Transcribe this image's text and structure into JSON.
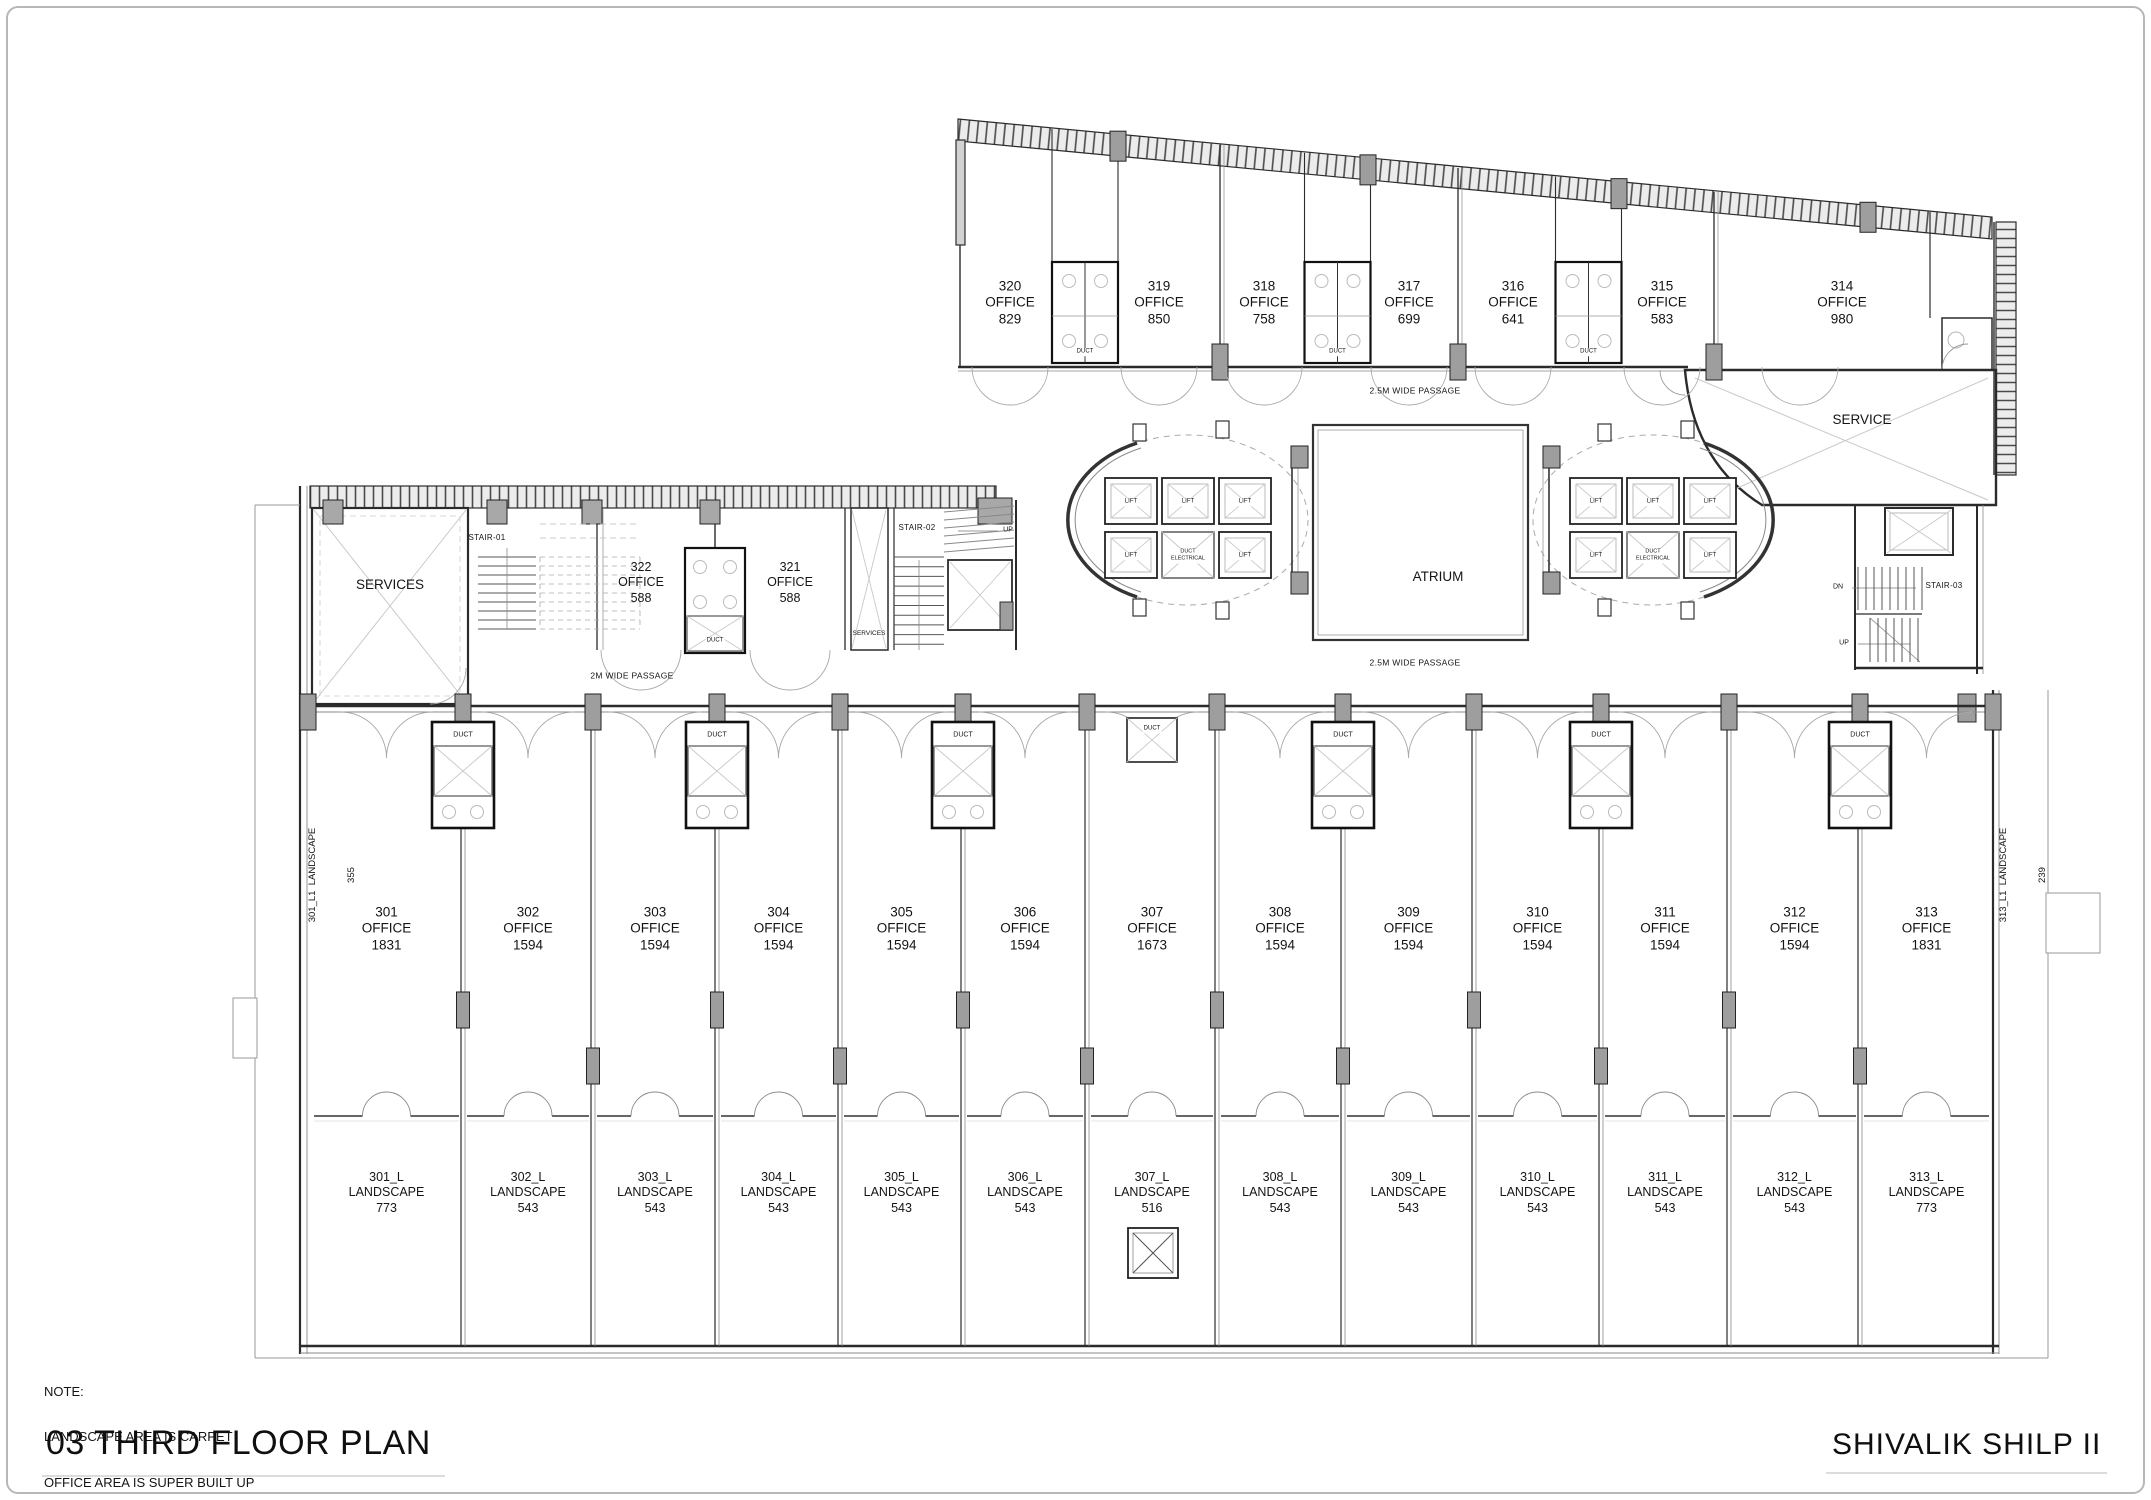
{
  "meta": {
    "plan_title": "03 THIRD FLOOR PLAN",
    "project_title": "SHIVALIK SHILP  II"
  },
  "note": {
    "heading": "NOTE:",
    "line1": "LANDSCAPE AREA IS CARPET",
    "line2": "OFFICE AREA IS SUPER BUILT UP"
  },
  "passages": {
    "top": "2.5M WIDE PASSAGE",
    "middle": "2.5M WIDE PASSAGE",
    "bottom": "2M WIDE PASSAGE"
  },
  "labels": {
    "office": "OFFICE",
    "landscape": "LANDSCAPE",
    "lift": "LIFT",
    "duct": "DUCT",
    "duct_electrical_line1": "DUCT",
    "duct_electrical_line2": "ELECTRICAL",
    "services": "SERVICES",
    "services_small": "SERVICES",
    "service": "SERVICE",
    "atrium": "ATRIUM",
    "stair_01": "STAIR-01",
    "stair_02": "STAIR-02",
    "stair_03": "STAIR-03",
    "up": "UP",
    "dn": "DN"
  },
  "top_offices": [
    {
      "number": "320",
      "area": "829"
    },
    {
      "number": "319",
      "area": "850"
    },
    {
      "number": "318",
      "area": "758"
    },
    {
      "number": "317",
      "area": "699"
    },
    {
      "number": "316",
      "area": "641"
    },
    {
      "number": "315",
      "area": "583"
    },
    {
      "number": "314",
      "area": "980"
    }
  ],
  "mid_offices": [
    {
      "number": "322",
      "area": "588"
    },
    {
      "number": "321",
      "area": "588"
    }
  ],
  "bottom_offices": [
    {
      "number": "301",
      "area": "1831"
    },
    {
      "number": "302",
      "area": "1594"
    },
    {
      "number": "303",
      "area": "1594"
    },
    {
      "number": "304",
      "area": "1594"
    },
    {
      "number": "305",
      "area": "1594"
    },
    {
      "number": "306",
      "area": "1594"
    },
    {
      "number": "307",
      "area": "1673"
    },
    {
      "number": "308",
      "area": "1594"
    },
    {
      "number": "309",
      "area": "1594"
    },
    {
      "number": "310",
      "area": "1594"
    },
    {
      "number": "311",
      "area": "1594"
    },
    {
      "number": "312",
      "area": "1594"
    },
    {
      "number": "313",
      "area": "1831"
    }
  ],
  "landscape_units": [
    {
      "number": "301_L",
      "area": "773"
    },
    {
      "number": "302_L",
      "area": "543"
    },
    {
      "number": "303_L",
      "area": "543"
    },
    {
      "number": "304_L",
      "area": "543"
    },
    {
      "number": "305_L",
      "area": "543"
    },
    {
      "number": "306_L",
      "area": "543"
    },
    {
      "number": "307_L",
      "area": "516"
    },
    {
      "number": "308_L",
      "area": "543"
    },
    {
      "number": "309_L",
      "area": "543"
    },
    {
      "number": "310_L",
      "area": "543"
    },
    {
      "number": "311_L",
      "area": "543"
    },
    {
      "number": "312_L",
      "area": "543"
    },
    {
      "number": "313_L",
      "area": "773"
    }
  ],
  "side_landscapes": {
    "left": {
      "line1": "301_L1  LANDSCAPE",
      "line2": "355"
    },
    "right": {
      "line1": "313_L1  LANDSCAPE",
      "line2": "239"
    }
  }
}
